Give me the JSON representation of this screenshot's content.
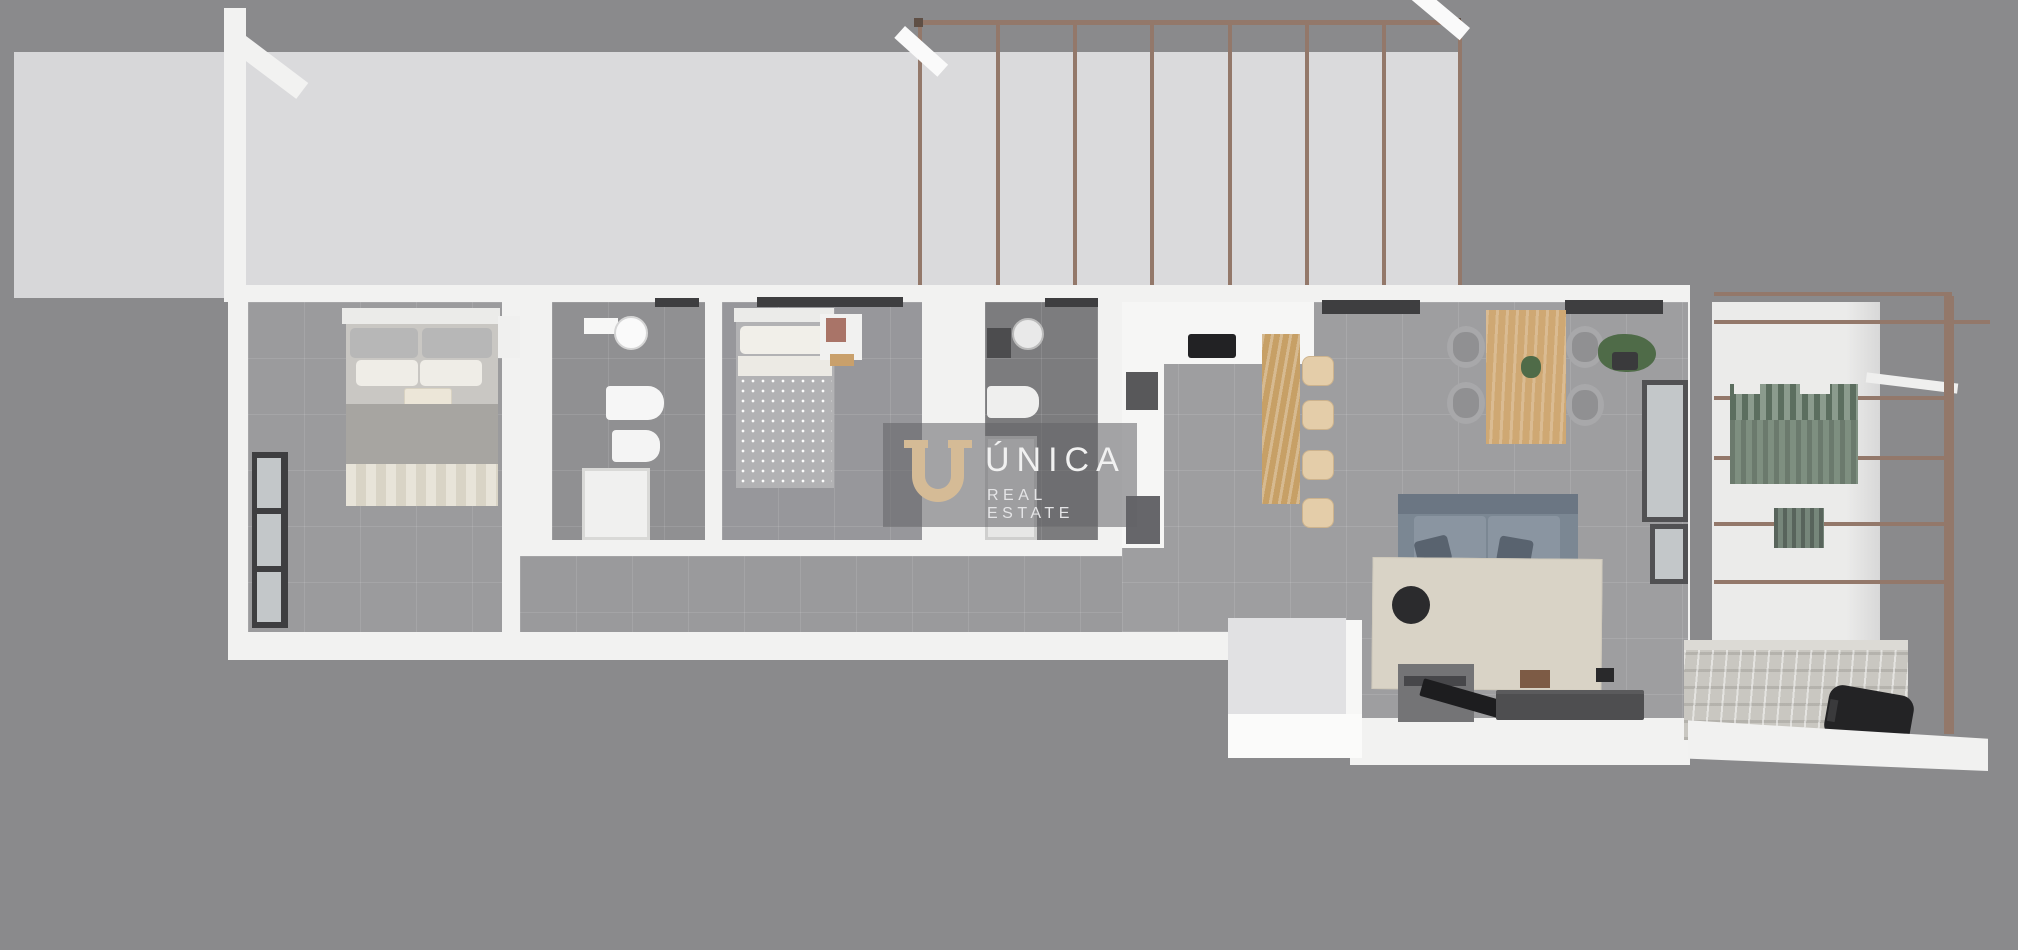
{
  "watermark": {
    "brand": "ÚNICA",
    "tagline": "REAL ESTATE"
  },
  "colors": {
    "bg": "#8a8a8c",
    "terrace": "#dadadc",
    "terraceLeft": "#d7d7d9",
    "wall": "#f2f2f1",
    "wallBright": "#fafafa",
    "floorMaster": "#9b9b9d",
    "floorBath1": "#909092",
    "floorBed2": "#97979b",
    "floorBath2": "#7c7c7e",
    "floorCorridor": "#9a9a9c",
    "floorLiving": "#9e9ea0",
    "pergola": "#93786a",
    "wood": "#c7a066",
    "woodLight": "#cfa873",
    "stoolTan": "#e4cda9",
    "chairGray": "#a8a8aa",
    "sofaGray": "#7b8793",
    "sofaDark": "#59636f",
    "rug": "#d9d3c6",
    "pouf": "#2b2b2d",
    "tvDark": "#1d1d1f",
    "shelfDark": "#4e4e50",
    "sideboard": "#747476",
    "green": "#7e8f80",
    "greenDark": "#5c6e5f",
    "plantGreen": "#4f6b48",
    "stone": "#c9c7c1",
    "grill": "#232325",
    "windowDark": "#3e3e40",
    "glass": "#c3c7c9",
    "wmBg": "rgba(98,98,102,0.55)",
    "brandTan": "#d5bb96",
    "brandText": "#f1f1f1"
  }
}
